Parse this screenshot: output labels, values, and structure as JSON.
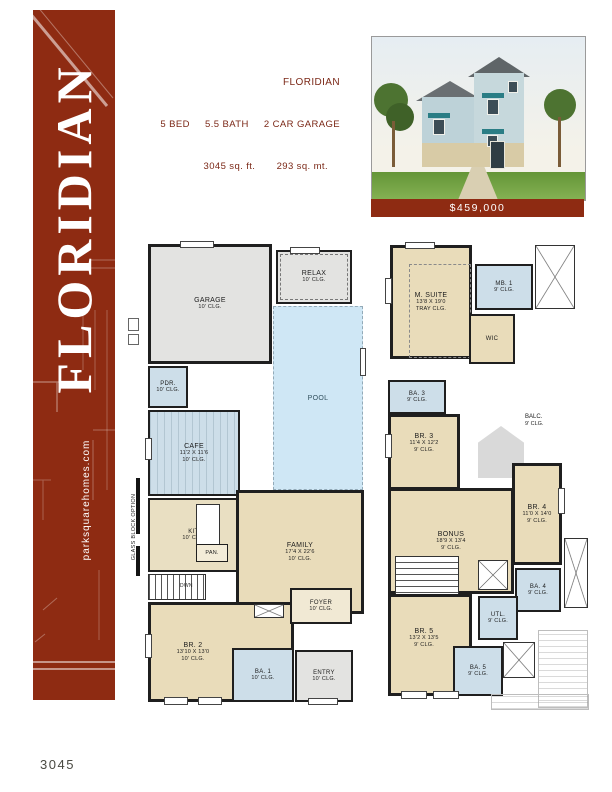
{
  "colors": {
    "accent": "#8e2b12",
    "floor_tan": "#e9dcba",
    "tile_blue": "#cddee9",
    "pool_blue": "#cfe7f5",
    "room_gray": "#e3e3e1"
  },
  "sidebar": {
    "title": "FLORIDIAN",
    "website": "parksquarehomes.com"
  },
  "header": {
    "title": "FLORIDIAN",
    "line_bed_bath": "5 BED     5.5 BATH     2 CAR GARAGE",
    "line_sqft": "3045 sq. ft.       293 sq. mt."
  },
  "photo": {
    "price": "$459,000"
  },
  "footer": {
    "plan_number": "3045"
  },
  "floor1": {
    "glass_note": "GLASS BLOCK OPTION",
    "rooms": {
      "garage": {
        "name": "GARAGE",
        "clg": "10' CLG."
      },
      "relax": {
        "name": "RELAX",
        "clg": "10' CLG."
      },
      "pool": {
        "name": "POOL"
      },
      "pdr": {
        "name": "PDR.",
        "clg": "10' CLG."
      },
      "cafe": {
        "name": "CAFE",
        "dims": "11'2 X 11'6",
        "clg": "10' CLG."
      },
      "kit": {
        "name": "KIT.",
        "clg": "10' CLG."
      },
      "pan": {
        "name": "PAN."
      },
      "family": {
        "name": "FAMILY",
        "dims": "17'4 X 22'6",
        "clg": "10' CLG."
      },
      "dwn": {
        "name": "DWN"
      },
      "br2": {
        "name": "BR. 2",
        "dims": "13'10 X 13'0",
        "clg": "10' CLG."
      },
      "ba1": {
        "name": "BA. 1",
        "clg": "10' CLG."
      },
      "foyer": {
        "name": "FOYER",
        "clg": "10' CLG."
      },
      "entry": {
        "name": "ENTRY",
        "clg": "10' CLG."
      }
    }
  },
  "floor2": {
    "rooms": {
      "msuite": {
        "name": "M. SUITE",
        "dims": "13'8 X 19'0",
        "clg": "TRAY CLG."
      },
      "mb1": {
        "name": "MB. 1",
        "clg": "9' CLG."
      },
      "wic": {
        "name": "WIC"
      },
      "ba3": {
        "name": "BA. 3",
        "clg": "9' CLG."
      },
      "br3": {
        "name": "BR. 3",
        "dims": "11'4 X 12'2",
        "clg": "9' CLG."
      },
      "balc": {
        "name": "BALC.",
        "clg": "9' CLG."
      },
      "bonus": {
        "name": "BONUS",
        "dims": "18'9 X 13'4",
        "clg": "9' CLG."
      },
      "br4": {
        "name": "BR. 4",
        "dims": "11'0 X 14'0",
        "clg": "9' CLG."
      },
      "ba4": {
        "name": "BA. 4",
        "clg": "9' CLG."
      },
      "utl": {
        "name": "UTL.",
        "clg": "9' CLG."
      },
      "br5": {
        "name": "BR. 5",
        "dims": "13'2 X 13'5",
        "clg": "9' CLG."
      },
      "ba5": {
        "name": "BA. 5",
        "clg": "9' CLG."
      }
    }
  }
}
